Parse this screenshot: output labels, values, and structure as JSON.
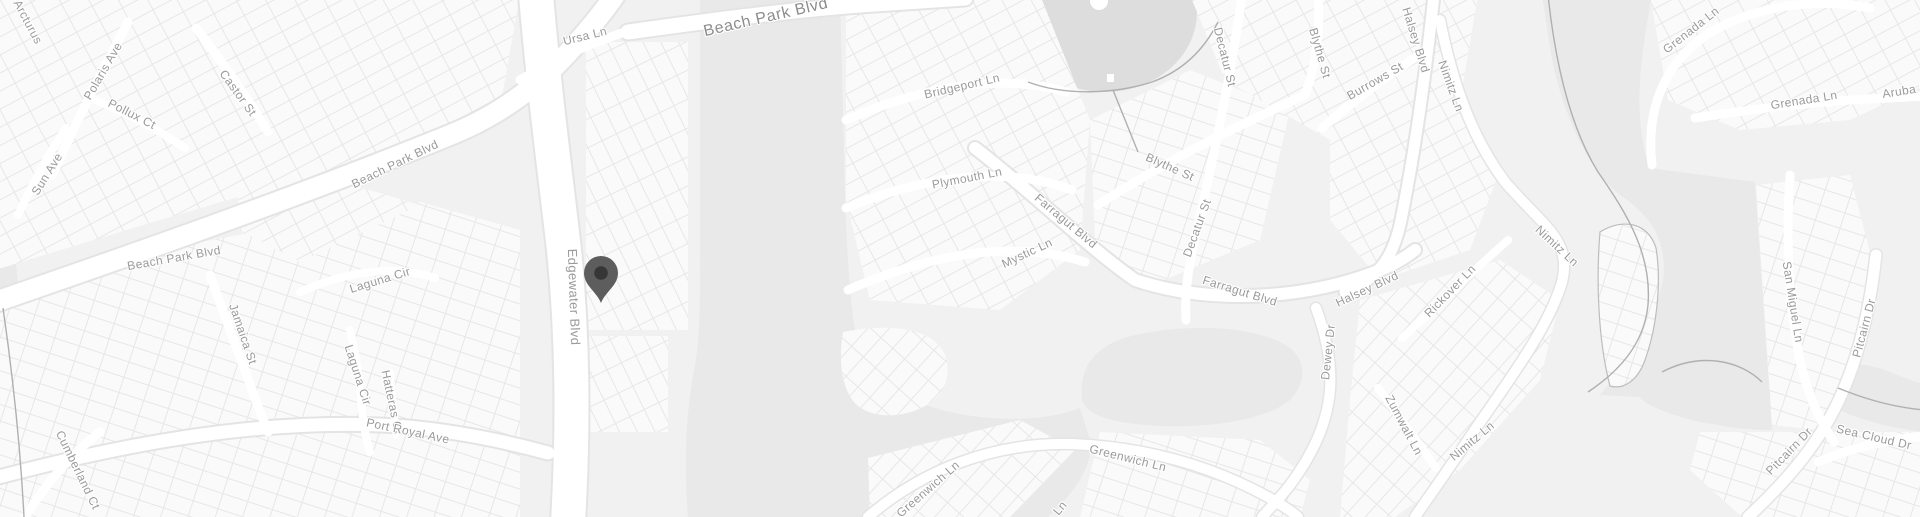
{
  "map": {
    "kind": "grayscale-street-map",
    "marker": {
      "label": "map-pin",
      "x": 601,
      "y": 267
    },
    "colors": {
      "land": "#f1f1f1",
      "parcel": "#fafafa",
      "parcel_line": "#e7e7e7",
      "water": "#e9e9e9",
      "pond": "#dddddd",
      "road": "#ffffff",
      "road_casing": "#e4e4e4",
      "shoreline": "#b0b0b0",
      "label_text": "#9a9a9a",
      "pin_body": "#5d5d5d",
      "pin_hole": "#363636"
    },
    "labels": [
      {
        "name": "street-label-arcturus",
        "text": "Arcturus",
        "x": 28,
        "y": 22,
        "rot": 62
      },
      {
        "name": "street-label-polaris-ave",
        "text": "Polaris Ave",
        "x": 103,
        "y": 71,
        "rot": -60
      },
      {
        "name": "street-label-pollux-ct",
        "text": "Pollux Ct",
        "x": 132,
        "y": 114,
        "rot": 27
      },
      {
        "name": "street-label-castor-st",
        "text": "Castor St",
        "x": 238,
        "y": 93,
        "rot": 54
      },
      {
        "name": "street-label-sun-ave",
        "text": "Sun Ave",
        "x": 47,
        "y": 174,
        "rot": -58
      },
      {
        "name": "street-label-beach-park-blvd-west",
        "text": "Beach Park Blvd",
        "x": 174,
        "y": 258,
        "rot": -10
      },
      {
        "name": "street-label-beach-park-blvd-mid",
        "text": "Beach Park Blvd",
        "x": 395,
        "y": 164,
        "rot": -26
      },
      {
        "name": "street-label-ursa-ln",
        "text": "Ursa Ln",
        "x": 585,
        "y": 36,
        "rot": -14
      },
      {
        "name": "street-label-beach-park-blvd-top",
        "text": "Beach Park Blvd",
        "x": 766,
        "y": 18,
        "rot": -13,
        "size": 16
      },
      {
        "name": "street-label-edgewater-blvd",
        "text": "Edgewater Blvd",
        "x": 574,
        "y": 297,
        "rot": 88,
        "size": 13
      },
      {
        "name": "street-label-jamaica-st",
        "text": "Jamaica St",
        "x": 243,
        "y": 334,
        "rot": 71
      },
      {
        "name": "street-label-laguna-cir-upper",
        "text": "Laguna Cir",
        "x": 380,
        "y": 280,
        "rot": -17
      },
      {
        "name": "street-label-laguna-cir-lower",
        "text": "Laguna Cir",
        "x": 358,
        "y": 375,
        "rot": 72
      },
      {
        "name": "street-label-hatteras-ct",
        "text": "Hatteras Ct",
        "x": 392,
        "y": 402,
        "rot": 78
      },
      {
        "name": "street-label-port-royal-ave",
        "text": "Port Royal Ave",
        "x": 408,
        "y": 431,
        "rot": 12
      },
      {
        "name": "street-label-cumberland-ct",
        "text": "Cumberland Ct",
        "x": 78,
        "y": 470,
        "rot": 64
      },
      {
        "name": "street-label-bridgeport-ln",
        "text": "Bridgeport Ln",
        "x": 962,
        "y": 86,
        "rot": -13
      },
      {
        "name": "street-label-plymouth-ln",
        "text": "Plymouth Ln",
        "x": 967,
        "y": 178,
        "rot": -11
      },
      {
        "name": "street-label-blythe-st-diag",
        "text": "Blythe St",
        "x": 1170,
        "y": 167,
        "rot": 24
      },
      {
        "name": "street-label-farragut-blvd-diag",
        "text": "Farragut Blvd",
        "x": 1066,
        "y": 221,
        "rot": 40
      },
      {
        "name": "street-label-mystic-ln",
        "text": "Mystic Ln",
        "x": 1027,
        "y": 253,
        "rot": -25
      },
      {
        "name": "street-label-decatur-st-top",
        "text": "Decatur St",
        "x": 1225,
        "y": 57,
        "rot": 76
      },
      {
        "name": "street-label-blythe-st-vert",
        "text": "Blythe St",
        "x": 1320,
        "y": 53,
        "rot": 74
      },
      {
        "name": "street-label-burrows-st",
        "text": "Burrows St",
        "x": 1375,
        "y": 81,
        "rot": -30
      },
      {
        "name": "street-label-halsey-blvd-top",
        "text": "Halsey Blvd",
        "x": 1416,
        "y": 40,
        "rot": 73
      },
      {
        "name": "street-label-nimitz-ln-top",
        "text": "Nimitz Ln",
        "x": 1451,
        "y": 86,
        "rot": 70
      },
      {
        "name": "street-label-decatur-st-mid",
        "text": "Decatur St",
        "x": 1197,
        "y": 228,
        "rot": -70
      },
      {
        "name": "street-label-farragut-blvd-mid",
        "text": "Farragut Blvd",
        "x": 1240,
        "y": 291,
        "rot": 17
      },
      {
        "name": "street-label-halsey-blvd-mid",
        "text": "Halsey Blvd",
        "x": 1367,
        "y": 289,
        "rot": -25
      },
      {
        "name": "street-label-dewey-dr",
        "text": "Dewey Dr",
        "x": 1328,
        "y": 352,
        "rot": -84
      },
      {
        "name": "street-label-rickover-ln",
        "text": "Rickover Ln",
        "x": 1450,
        "y": 291,
        "rot": -46
      },
      {
        "name": "street-label-nimitz-ln-mid",
        "text": "Nimitz Ln",
        "x": 1557,
        "y": 246,
        "rot": 43
      },
      {
        "name": "street-label-zumwalt-ln",
        "text": "Zumwalt Ln",
        "x": 1404,
        "y": 425,
        "rot": 62
      },
      {
        "name": "street-label-nimitz-ln-bottom",
        "text": "Nimitz Ln",
        "x": 1472,
        "y": 441,
        "rot": -40
      },
      {
        "name": "street-label-greenwich-ln-east",
        "text": "Greenwich Ln",
        "x": 1128,
        "y": 458,
        "rot": 14
      },
      {
        "name": "street-label-greenwich-ln-west",
        "text": "Greenwich Ln",
        "x": 928,
        "y": 489,
        "rot": -41
      },
      {
        "name": "street-label-ln-fragment",
        "text": "Ln",
        "x": 1060,
        "y": 508,
        "rot": -50
      },
      {
        "name": "street-label-grenada-ln-diag",
        "text": "Grenada Ln",
        "x": 1691,
        "y": 30,
        "rot": -38
      },
      {
        "name": "street-label-grenada-ln-horiz",
        "text": "Grenada Ln",
        "x": 1804,
        "y": 100,
        "rot": -9
      },
      {
        "name": "street-label-aruba-ln",
        "text": "Aruba Ln",
        "x": 1908,
        "y": 90,
        "rot": -9
      },
      {
        "name": "street-label-san-miguel-ln",
        "text": "San Miguel Ln",
        "x": 1793,
        "y": 302,
        "rot": 81
      },
      {
        "name": "street-label-pitcairn-dr-upper",
        "text": "Pitcairn Dr",
        "x": 1864,
        "y": 328,
        "rot": -75
      },
      {
        "name": "street-label-pitcairn-dr-lower",
        "text": "Pitcairn Dr",
        "x": 1789,
        "y": 451,
        "rot": -46
      },
      {
        "name": "street-label-sea-cloud-dr",
        "text": "Sea Cloud Dr",
        "x": 1874,
        "y": 437,
        "rot": 13
      }
    ]
  }
}
